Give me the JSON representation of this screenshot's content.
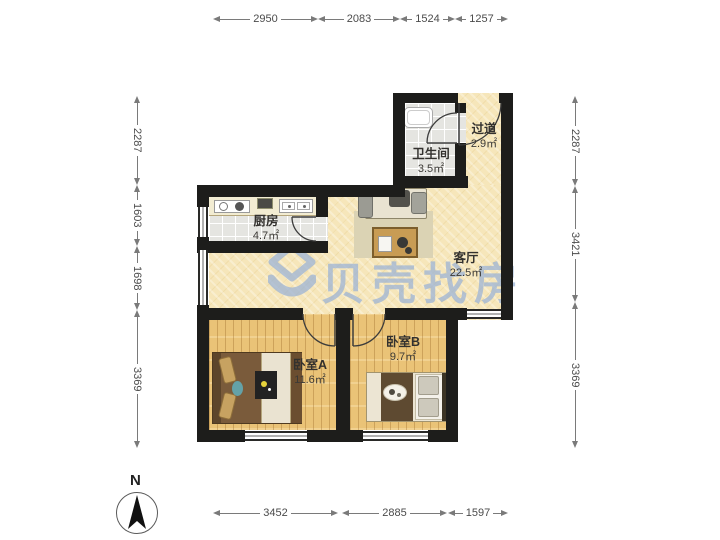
{
  "watermark": {
    "brand": "贝壳找房"
  },
  "compass": {
    "north_label": "N"
  },
  "rooms": {
    "bathroom": {
      "name": "卫生间",
      "area": "3.5㎡"
    },
    "hallway": {
      "name": "过道",
      "area": "2.9㎡"
    },
    "kitchen": {
      "name": "厨房",
      "area": "4.7㎡"
    },
    "living": {
      "name": "客厅",
      "area": "22.5㎡"
    },
    "bedroom_a": {
      "name": "卧室A",
      "area": "11.6㎡"
    },
    "bedroom_b": {
      "name": "卧室B",
      "area": "9.7㎡"
    }
  },
  "dimensions_mm": {
    "top": [
      "2950",
      "2083",
      "1524",
      "1257"
    ],
    "bottom": [
      "3452",
      "2885",
      "1597"
    ],
    "left": [
      "2287",
      "1603",
      "1698",
      "3369"
    ],
    "right": [
      "2287",
      "3421",
      "3369"
    ]
  },
  "colors": {
    "wall": "#1d1d1b",
    "floor_living": "#f6e6ba",
    "floor_wood": "#eac377",
    "floor_tile": "#e5e5e1",
    "watermark_blue": "#98b1d6"
  }
}
